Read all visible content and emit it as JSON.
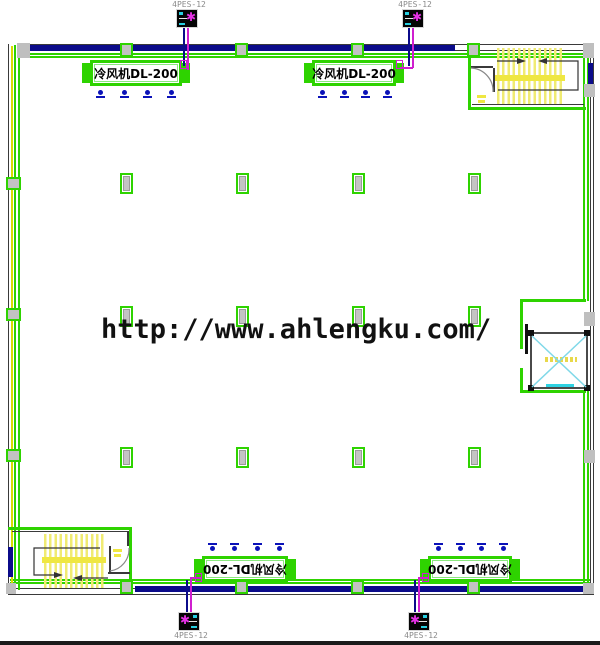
{
  "watermark": {
    "text": "http://www.ahlengku.com/"
  },
  "equipment": {
    "air_cooler": {
      "label": "冷风机DL-200"
    },
    "panel": {
      "label": "4PES-12",
      "fan_glyph": "✱"
    }
  },
  "rooms": {
    "stairwells": 2,
    "elevator_shafts": 1
  },
  "colors": {
    "wall_green": "#2ed300",
    "window_navy": "#0b0b8a",
    "pipe_magenta": "#cf1fcf",
    "stair_yellow": "#efe96a",
    "elevator_cyan": "#32cfe0",
    "column_gray": "#c2c2c2",
    "watermark_text": "#111111"
  }
}
